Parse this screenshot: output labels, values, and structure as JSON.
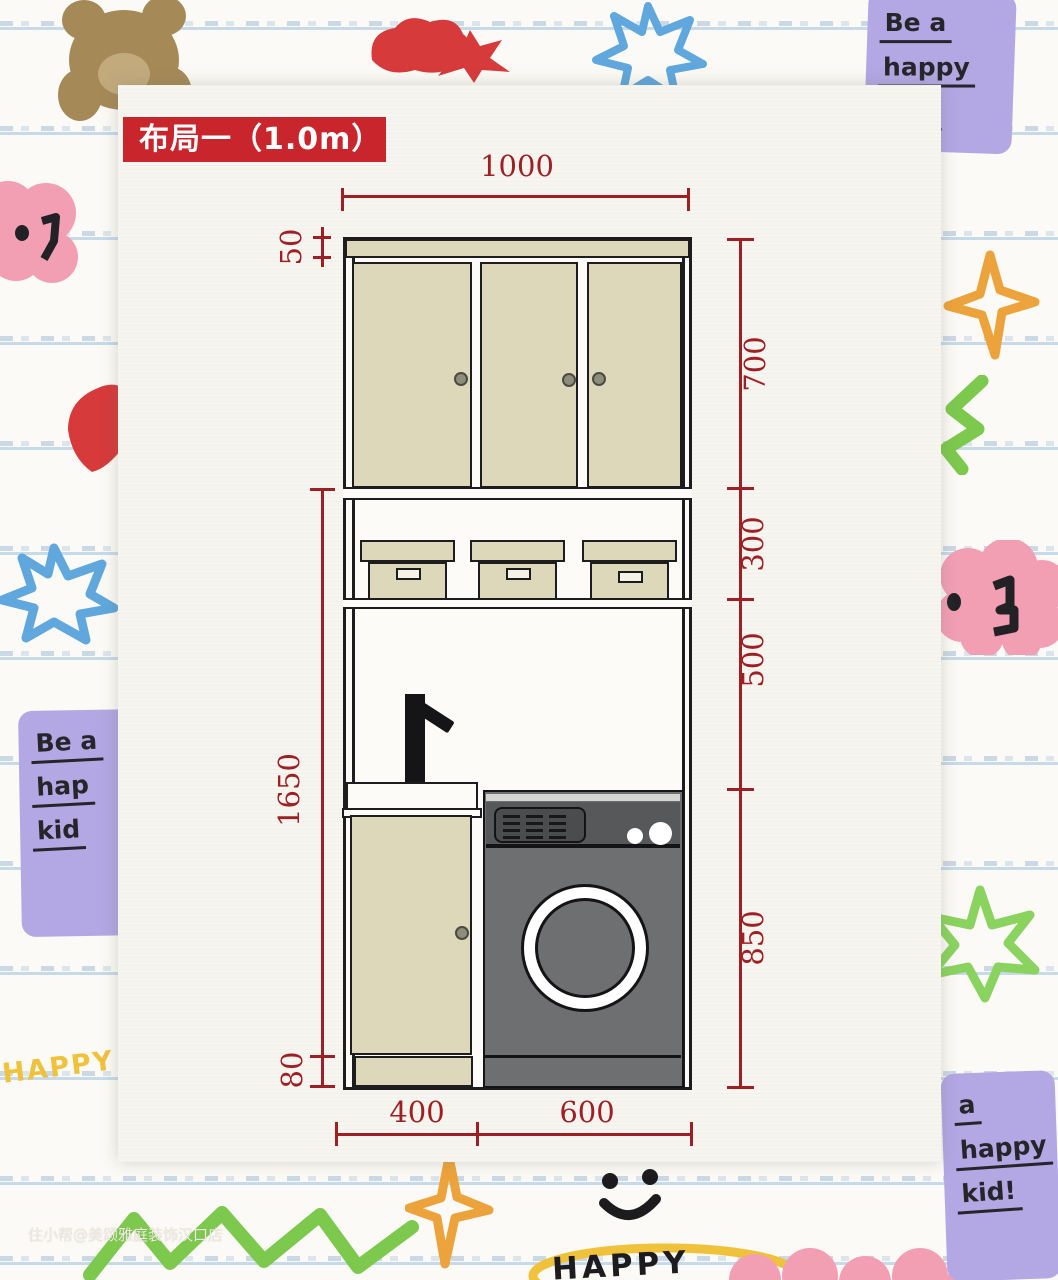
{
  "title": {
    "badge": "布局一（1.0m）"
  },
  "dimensions": {
    "top_width": "1000",
    "top_strip": "50",
    "upper_cabinet": "700",
    "shelf_section": "300",
    "open_section": "500",
    "washer_section": "850",
    "lower_total": "1650",
    "kick_plate": "80",
    "sink_width": "400",
    "washer_width": "600"
  },
  "doodles": {
    "note_top_right": {
      "line1": "Be a",
      "line2": "happy",
      "line3": "kid!"
    },
    "note_left": {
      "line1": "Be a",
      "line2": "hap",
      "line3": "kid"
    },
    "note_bottom_right": {
      "line1": "a",
      "line2": "happy",
      "line3": "kid!"
    },
    "happy_left": "HAPPY",
    "happy_bottom": "HAPPY"
  },
  "watermark": "住小帮@美颂雅庭装饰汉口店",
  "colors": {
    "title_red": "#c8262c",
    "dimension_red": "#9e2025",
    "cabinet_beige": "#ded8ba",
    "washer_gray": "#6e6f71",
    "washer_panel_gray": "#57585a",
    "paper_line_blue": "#bcd4e8",
    "doodle_purple": "#b3a7e4",
    "doodle_pink": "#f29fb4",
    "doodle_blue": "#5fa7dd",
    "doodle_green": "#7cc94e",
    "doodle_orange": "#eda33b",
    "doodle_yellow": "#f0c23c",
    "doodle_red": "#d63a3a",
    "doodle_brown": "#a58a58"
  }
}
